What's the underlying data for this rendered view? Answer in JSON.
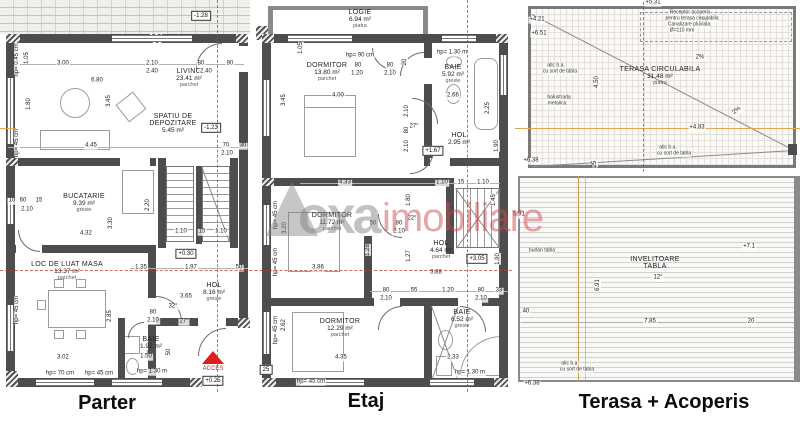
{
  "footer": {
    "parter": "Parter",
    "etaj": "Etaj",
    "terasa": "Terasa + Acoperis"
  },
  "watermark": {
    "logo": "oxa",
    "suffix": "imobiliare"
  },
  "parter": {
    "rooms": {
      "living": {
        "name": "LIVING",
        "area": "23.41 m²",
        "floor": "parchet"
      },
      "depozitare": {
        "name1": "SPATIU DE",
        "name2": "DEPOZITARE",
        "area": "5.45 m²"
      },
      "bucatarie": {
        "name": "BUCATARIE",
        "area": "9.39 m²",
        "floor": "gresie"
      },
      "dining": {
        "name": "LOC DE LUAT MASA",
        "area": "13.37 m²",
        "floor": "parchet"
      },
      "hol": {
        "name": "HOL",
        "area": "8.16 m²",
        "floor": "gresie"
      },
      "baie": {
        "name": "BAIE",
        "area": "1.92 m²",
        "width": "1.50"
      }
    },
    "levels": {
      "terrace": "-1.28",
      "depozit": "-1.23",
      "stair": "+0.30",
      "entry": "+0.25"
    },
    "acces": "ACCES",
    "dims": [
      "3.00",
      "2.10",
      "2.40",
      "80",
      "2.40",
      "90",
      "6.80",
      "4.45",
      "70",
      "30",
      "2.10",
      "4.32",
      "1.10",
      "15",
      "1.10",
      "1.35",
      "1.97",
      "50",
      "3.65",
      "80",
      "2.10",
      "32°",
      "27°",
      "3.02",
      "1.50",
      "hp= 1.30 m",
      "hp= 70 cm",
      "hp= 45 cm",
      "2.10",
      "10",
      "60",
      "15"
    ],
    "vdims": [
      "hp= 0.45 cm",
      "1.05",
      "3.45",
      "1.80",
      "hp= 45 cm",
      "2.20",
      "3.30",
      "hp= 45 cm",
      "2.85",
      "50"
    ]
  },
  "etaj": {
    "rooms": {
      "logie": {
        "name": "LOGIE",
        "area": "6.94 m²",
        "floor": "piatra"
      },
      "dormitor1": {
        "name": "DORMITOR",
        "area": "13.80 m²",
        "floor": "parchet"
      },
      "baie1": {
        "name": "BAIE",
        "area": "5.92 m²",
        "floor": "gresie"
      },
      "hol1": {
        "name": "HOL",
        "area": "2.95 m²"
      },
      "dormitor2": {
        "name": "DORMITOR",
        "area": "11.72 m²",
        "floor": "parchet"
      },
      "hol2": {
        "name": "HOL",
        "area": "4.64 m²",
        "floor": "parchet"
      },
      "dormitor3": {
        "name": "DORMITOR",
        "area": "12.29 m²",
        "floor": "parchet"
      },
      "baie2": {
        "name": "BAIE",
        "area": "6.52 m²",
        "floor": "gresie"
      }
    },
    "levels": {
      "hol_top": "+1.67",
      "hol_mid": "+3.05",
      "left": "25"
    },
    "dims": [
      "hp= 90 cm",
      "hp= 1.30 m",
      "80",
      "1.20",
      "80",
      "2.10",
      "4.00",
      "2.66",
      "27°",
      "4.33",
      "1.10",
      "15",
      "1.10",
      "50",
      "80",
      "2.10",
      "22°",
      "3.86",
      "3.88",
      "80",
      "2.10",
      "55",
      "1.20",
      "80",
      "33",
      "2.10",
      "4.35",
      "2.33",
      "hp= 1.30 m",
      "hp= 45 cm"
    ],
    "vdims": [
      "1.05",
      "3.45",
      "20",
      "2.25",
      "2.10",
      "80",
      "2.10",
      "1.90",
      "1.80",
      "1.45",
      "hp= 45 cm",
      "3.20",
      "1.28",
      "1.27",
      "hp= 45 cm",
      "1.90",
      "hp= 45 cm",
      "2.62"
    ]
  },
  "terasa": {
    "rooms": {
      "terasa": {
        "name": "TERASA CIRCULABILA",
        "area": "31.48 m²",
        "floor": "piatra"
      },
      "roof": {
        "name1": "INVELITOARE",
        "name2": "TABLA",
        "slope": "12°"
      }
    },
    "levels": [
      "+5.31",
      "+4.21",
      "+6.51",
      "+4.83",
      "+6.38",
      "+7.1",
      "+6.38"
    ],
    "slopes": [
      "2%",
      "2%",
      "2%"
    ],
    "notes": [
      "Receptor acoperis",
      "pentru terasa circulabila",
      "Canalizare pluviala",
      "Ø=110 mm",
      "atic b.a.",
      "cu sort de tabla",
      "balustrada",
      "metalica",
      "atic b.a.",
      "cu sort de tabla",
      "burlan tabla",
      "atic b.a.",
      "cu sort de tabla"
    ],
    "dims": [
      "4.50",
      "25",
      "5.91",
      "6.91",
      "40",
      "7.85",
      "20"
    ]
  }
}
